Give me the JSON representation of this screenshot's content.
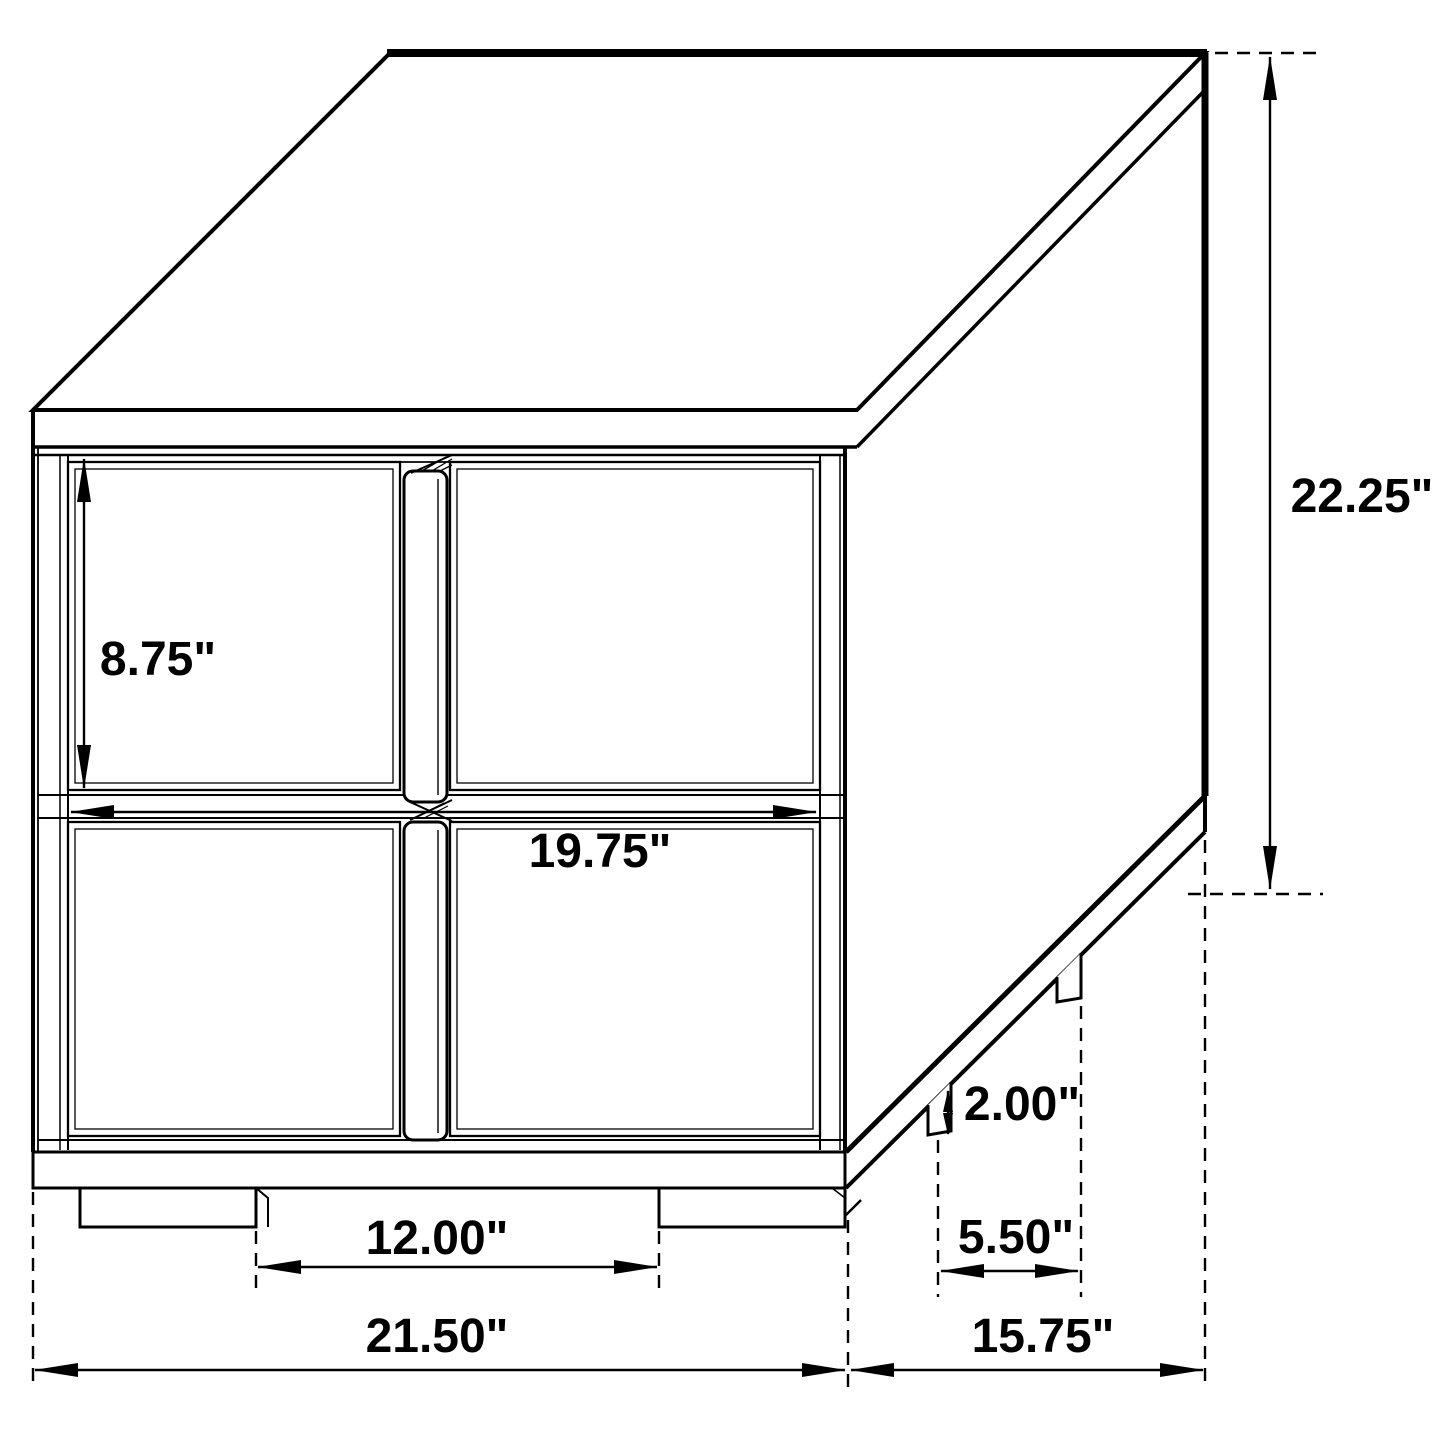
{
  "diagram": {
    "type": "furniture-dimension-drawing",
    "subject": "Two-drawer nightstand, isometric technical line drawing with dimension callouts",
    "background_color": "#ffffff",
    "line_color": "#000000",
    "text_color": "#000000",
    "unit": "inches",
    "dimensions": {
      "drawer_face_height": "8.75\"",
      "overall_height": "22.25\"",
      "drawer_width": "19.75\"",
      "leg_height": "2.00\"",
      "front_leg_spacing": "12.00\"",
      "side_leg_spacing": "5.50\"",
      "overall_width": "21.50\"",
      "overall_depth": "15.75\""
    }
  }
}
